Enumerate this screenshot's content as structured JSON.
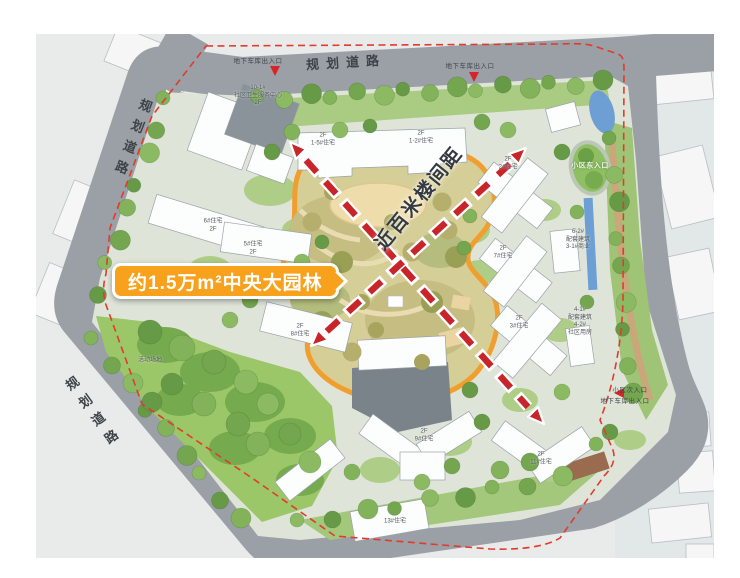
{
  "theme": {
    "callout-bg": "#f7a11d",
    "garden-stroke": "#f09f2e",
    "arrow-red": "#c8252b",
    "boundary-red": "#e23b2e",
    "road-gray": "#9aa0a5",
    "water-blue": "#6d9fd4",
    "label-dark": "#3d4347"
  },
  "map": {
    "road_labels": {
      "top": "规划道路",
      "left": "规划道路",
      "bottom_left": "规划道路"
    },
    "callout": {
      "text": "约1.5万m²中央大园林"
    },
    "spacing_label": "近百米楼间距",
    "entrances": [
      {
        "label": "地下车库出入口",
        "x": 258,
        "y": 62
      },
      {
        "label": "地下车库出入口",
        "x": 470,
        "y": 67
      },
      {
        "label": "小区东入口",
        "x": 590,
        "y": 167,
        "variant": "light"
      },
      {
        "label": "小区次入口",
        "x": 630,
        "y": 391
      },
      {
        "label": "地下车库出入口",
        "x": 625,
        "y": 402
      }
    ],
    "building_labels": [
      {
        "text": "10-1#\n社区卫生服务中心\n2F",
        "x": 258,
        "y": 96
      },
      {
        "text": "2F\n1-5#住宅",
        "x": 323,
        "y": 140
      },
      {
        "text": "2F\n1-2#住宅",
        "x": 421,
        "y": 138
      },
      {
        "text": "6#住宅\n2F",
        "x": 213,
        "y": 226
      },
      {
        "text": "5#住宅\n2F",
        "x": 253,
        "y": 249
      },
      {
        "text": "2F\n2#住宅",
        "x": 508,
        "y": 164
      },
      {
        "text": "2F\n7#住宅",
        "x": 503,
        "y": 253
      },
      {
        "text": "6-2#\n配套建筑\n3-1#商业",
        "x": 578,
        "y": 240
      },
      {
        "text": "2F\n3#住宅",
        "x": 519,
        "y": 323
      },
      {
        "text": "4-1#\n配套建筑\n4-2#\n社区用房",
        "x": 580,
        "y": 322
      },
      {
        "text": "2F\n8#住宅",
        "x": 300,
        "y": 331
      },
      {
        "text": "2F\n9#住宅",
        "x": 424,
        "y": 436
      },
      {
        "text": "2F\n11#住宅",
        "x": 541,
        "y": 459
      },
      {
        "text": "13#住宅",
        "x": 395,
        "y": 522
      },
      {
        "text": "活动场地",
        "x": 150,
        "y": 361
      }
    ]
  }
}
